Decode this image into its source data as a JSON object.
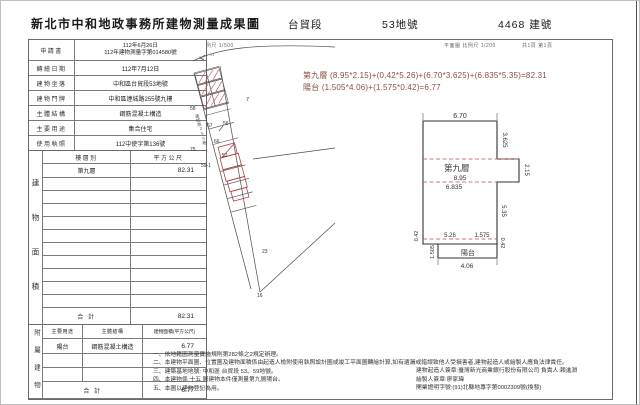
{
  "header": {
    "title": "新北市中和地政事務所建物測量成果圖",
    "section": "台貿段",
    "lot_no": "53地號",
    "building_no": "4468 建號",
    "scale_site": "位置圖 比例尺 1/500",
    "scale_plan": "平面圖 比例尺 1/200",
    "page_info": "共1頁 第1頁"
  },
  "info_table": {
    "rows": [
      {
        "label": "申請書",
        "value": "112年6月26日",
        "value2": "112年建物測量字第014580號"
      },
      {
        "label": "轉繪日期",
        "value": "112年7月12日"
      },
      {
        "label": "建物坐落",
        "value": "中和區台貿段53地號"
      },
      {
        "label": "建物門牌",
        "value": "中和區連城路255號九樓"
      },
      {
        "label": "主體結構",
        "value": "鋼筋混凝土構造"
      },
      {
        "label": "主要用途",
        "value": "集合住宅"
      },
      {
        "label": "使用執照",
        "value": "112中使字第136號"
      }
    ]
  },
  "area_table": {
    "side_label": "建物面積",
    "col_floor": "樓層別",
    "col_area": "平方公尺",
    "floor": "第九層",
    "area": "82.31",
    "total_label": "合 計",
    "total": "82.31"
  },
  "annex_table": {
    "side_label": "附屬建物",
    "col_use": "主要用途",
    "col_structure": "主體結構",
    "col_area": "建物面積(平方公尺)",
    "use": "陽台",
    "structure": "鋼筋混凝土構造",
    "area": "6.77",
    "total_label": "合 計",
    "total": "6.77"
  },
  "formulas": {
    "line1": "第九層 (8.95*2.15)+(0.42*5.26)+(6.70*3.625)+(6.835*5.35)=82.31",
    "line2": "陽台 (1.505*4.06)+(1.575*0.42)=6.77"
  },
  "site_plan": {
    "road_label": "連城路255巷",
    "labels": {
      "l50": "50",
      "l51": "51",
      "l58": "58",
      "l7": "7",
      "l67": "67",
      "l56": "56",
      "l66": "66",
      "l52": "52",
      "l75": "75",
      "l59_1": "59-1",
      "l23": "23",
      "l16": "16"
    }
  },
  "floor_plan": {
    "room": "第九層",
    "balcony": "陽台",
    "d_top": "6.70",
    "d_right_top": "3.625",
    "d_ext": "2.15",
    "d_w1": "8.95",
    "d_w2": "6.835",
    "d_right": "5.35",
    "d_left_s": "0.42",
    "d_b1": "5.26",
    "d_b2": "1.575",
    "d_right_s": "0.42",
    "d_bal_h": "1.505",
    "d_bal_w": "4.06"
  },
  "notes": {
    "n1": "一、依地籍圖測量實施規則第282條之2規定辦理。",
    "n2": "二、本建物平面圖、位置圖及建物面積係由起造人檢附使用執照設計圖或竣工平面圖轉繪計算,如有遺漏或錯誤致他人受損害者,建物起造人或繪製人應負法律責任。",
    "n3": "三、建築基地地號: 中和區 台貿段 53、59地號。",
    "n4": "四、本建物係 十五 層建物本件僅測量第九層陽台。",
    "n5": "五、本圖以建物登記為用。",
    "sig1": "建物起造人簽章:臺灣新光商業銀行股份有限公司 負責人:賴進淵",
    "sig2": "繪製人簽章:廖家瑋",
    "sig3": "開業證明字號:(91)北縣地專字第0002309號(換發)"
  },
  "colors": {
    "accent_red": "#b0413e",
    "formula_text": "#8a4f41",
    "line": "#444444"
  }
}
